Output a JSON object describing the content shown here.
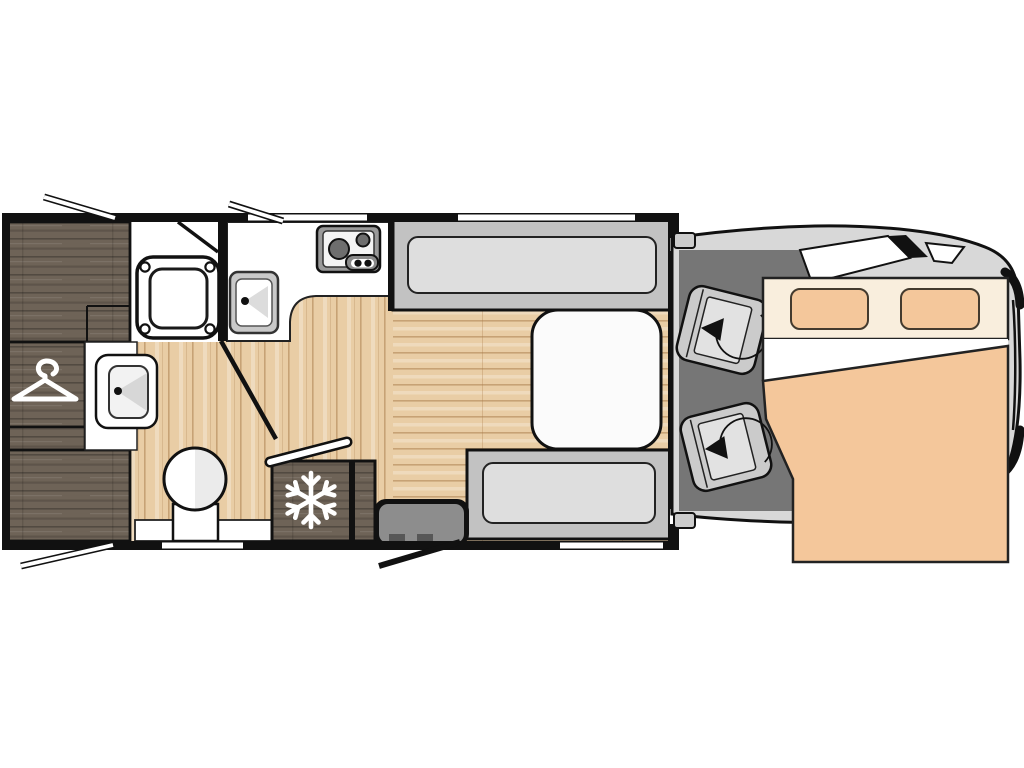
{
  "diagram": {
    "type": "motorhome-floor-plan",
    "orientation": "cab-on-right",
    "areas": [
      {
        "name": "wardrobe",
        "icon": "hanger-icon"
      },
      {
        "name": "shower-room",
        "fixture": "shower-tray"
      },
      {
        "name": "bathroom",
        "fixtures": [
          "washbasin",
          "toilet"
        ]
      },
      {
        "name": "kitchen",
        "fixtures": [
          "kitchen-sink",
          "two-burner-hob",
          "refrigerator"
        ]
      },
      {
        "name": "dinette",
        "fixtures": [
          "front-bench-seat",
          "table",
          "rear-bench-seat"
        ]
      },
      {
        "name": "entry",
        "fixtures": [
          "entry-step",
          "entry-door"
        ]
      },
      {
        "name": "cab",
        "fixtures": [
          "passenger-swivel-seat",
          "driver-swivel-seat"
        ]
      },
      {
        "name": "overcab-bed",
        "fixtures": [
          "pillow-left",
          "pillow-right",
          "duvet"
        ]
      }
    ],
    "icons": [
      "hanger-icon",
      "snowflake-icon",
      "swivel-arrow-icon"
    ],
    "openings": {
      "top_wall_windows": 2,
      "bottom_wall_windows": 2,
      "open_window_flaps": 3,
      "doors": [
        "shower-door",
        "bathroom-door",
        "entry-door"
      ]
    },
    "colors": {
      "wall": "#111111",
      "wood": "#6e6357",
      "floor": "#e9cda5",
      "bench": "#c2c2c2",
      "cushion": "#dedede",
      "cabfloor": "#767676",
      "body": "#d8d8d8",
      "peach": "#f4c79b",
      "bedhead": "#f9eedd",
      "step": "#8d8d8d",
      "table": "#fbfbfb",
      "seat": "#cbcbcb",
      "white": "#ffffff"
    }
  }
}
